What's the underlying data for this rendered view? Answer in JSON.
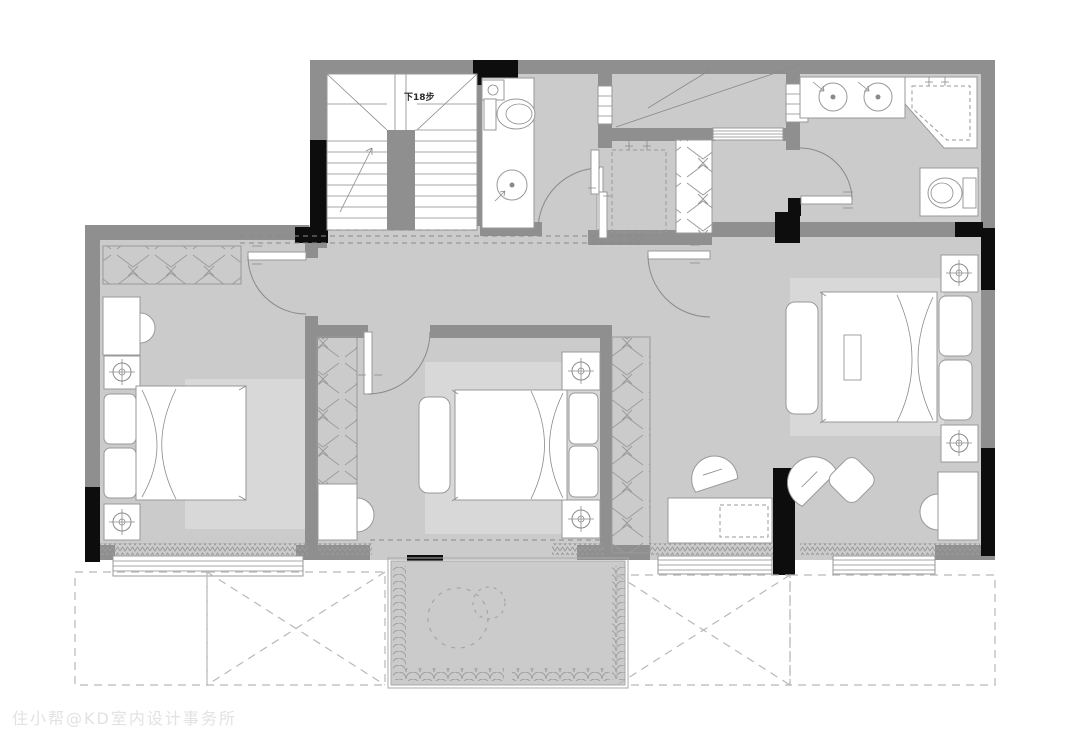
{
  "labels": {
    "stairs": "下18步"
  },
  "watermark": {
    "text": "住小帮@KD室内设计事务所"
  },
  "colors": {
    "wall": "#8f8f8f",
    "wall_black": "#0d0d0d",
    "floor": "#cbcbcb",
    "rug": "#d8d8d8",
    "fixture": "#ffffff",
    "line": "#8a8a8a",
    "outline": "#999999",
    "watermark": "#e2e2e2"
  },
  "legend": {
    "stairwell": {
      "label": "下18步",
      "items": [
        "u-shaped-stair",
        "break-line-arrow"
      ]
    },
    "hall": {
      "items": [
        "beam-dashed-lines"
      ]
    },
    "bathroom_top": {
      "items": [
        "toilet",
        "round-basin",
        "small-sink",
        "swing-door",
        "sliding-door"
      ]
    },
    "shower_laundry": {
      "items": [
        "dashed-enclosure",
        "shower-heads",
        "wardrobe-strip"
      ]
    },
    "master_bathroom": {
      "items": [
        "double-sink-vanity",
        "corner-shower",
        "toilet",
        "swing-door"
      ]
    },
    "bedroom_left": {
      "items": [
        "wardrobe",
        "desk",
        "chair",
        "bed",
        "two-nightstand-lamps",
        "rug",
        "window"
      ]
    },
    "bedroom_middle": {
      "items": [
        "wardrobe",
        "desk",
        "chair",
        "bed",
        "bench",
        "two-nightstand-lamps",
        "rug"
      ]
    },
    "bedroom_master": {
      "items": [
        "wardrobe",
        "bed",
        "bench",
        "two-nightstand-lamps",
        "desk-with-chair",
        "lounge-chair-with-ottoman",
        "dressing-desk",
        "rug",
        "windows"
      ]
    },
    "balcony_center": {
      "items": [
        "planter-hatch-border",
        "plant-circles"
      ]
    },
    "roof_below": {
      "items": [
        "dashed-box",
        "dashed-x-box",
        "dashed-x-box",
        "dashed-box"
      ]
    }
  }
}
